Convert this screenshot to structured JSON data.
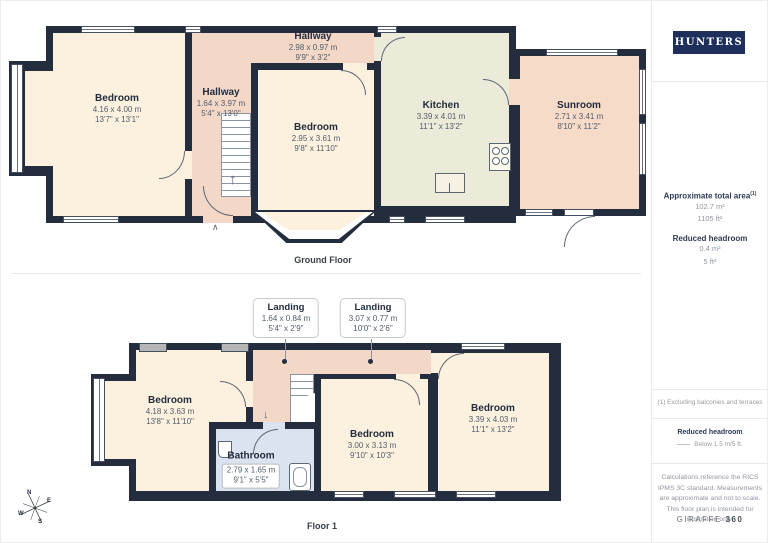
{
  "brand": {
    "name": "HUNTERS",
    "color": "#1e2f5c"
  },
  "gf": {
    "label": "Ground Floor",
    "rooms": {
      "bed_left": {
        "name": "Bedroom",
        "metric": "4.16 x 4.00 m",
        "imperial": "13'7\" x 13'1\""
      },
      "hall_top": {
        "name": "Hallway",
        "metric": "2.98 x 0.97 m",
        "imperial": "9'9\" x 3'2\""
      },
      "hall": {
        "name": "Hallway",
        "metric": "1.64 x 3.97 m",
        "imperial": "5'4\" x 13'0\""
      },
      "bed_mid": {
        "name": "Bedroom",
        "metric": "2.95 x 3.61 m",
        "imperial": "9'8\" x 11'10\""
      },
      "kitchen": {
        "name": "Kitchen",
        "metric": "3.39 x 4.01 m",
        "imperial": "11'1\" x 13'2\""
      },
      "sunroom": {
        "name": "Sunroom",
        "metric": "2.71 x 3.41 m",
        "imperial": "8'10\" x 11'2\""
      }
    }
  },
  "f1": {
    "label": "Floor 1",
    "callouts": {
      "a": {
        "name": "Landing",
        "metric": "1.64 x 0.84 m",
        "imperial": "5'4\" x 2'9\""
      },
      "b": {
        "name": "Landing",
        "metric": "3.07 x 0.77 m",
        "imperial": "10'0\" x 2'6\""
      }
    },
    "rooms": {
      "bed_left": {
        "name": "Bedroom",
        "metric": "4.18 x 3.63 m",
        "imperial": "13'8\" x 11'10\""
      },
      "bathroom": {
        "name": "Bathroom",
        "metric": "2.79 x 1.65 m",
        "imperial": "9'1\" x 5'5\""
      },
      "bed_mid": {
        "name": "Bedroom",
        "metric": "3.00 x 3.13 m",
        "imperial": "9'10\" x 10'3\""
      },
      "bed_right": {
        "name": "Bedroom",
        "metric": "3.39 x 4.03 m",
        "imperial": "11'1\" x 13'2\""
      }
    }
  },
  "compass": {
    "n": "N",
    "e": "E",
    "s": "S",
    "w": "W"
  },
  "icons": {
    "up_arrow": "↑",
    "down_arrow": "↓",
    "entrance": "∧"
  },
  "sidebar": {
    "total_label": "Approximate total area",
    "total_sup": "(1)",
    "total_metric": "102.7 m²",
    "total_imperial": "1105 ft²",
    "reduced_label": "Reduced headroom",
    "reduced_metric": "0.4 m²",
    "reduced_imperial": "5 ft²",
    "footnote": "(1) Excluding balconies and terraces",
    "legend_title": "Reduced headroom",
    "legend_item": "Below 1.5 m/5 ft.",
    "disclaimer": "Calculations reference the RICS IPMS 3C standard. Measurements are approximate and not to scale. This floor plan is intended for illustration only.",
    "credit_name": "GIRAFFE",
    "credit_suffix": "360"
  }
}
